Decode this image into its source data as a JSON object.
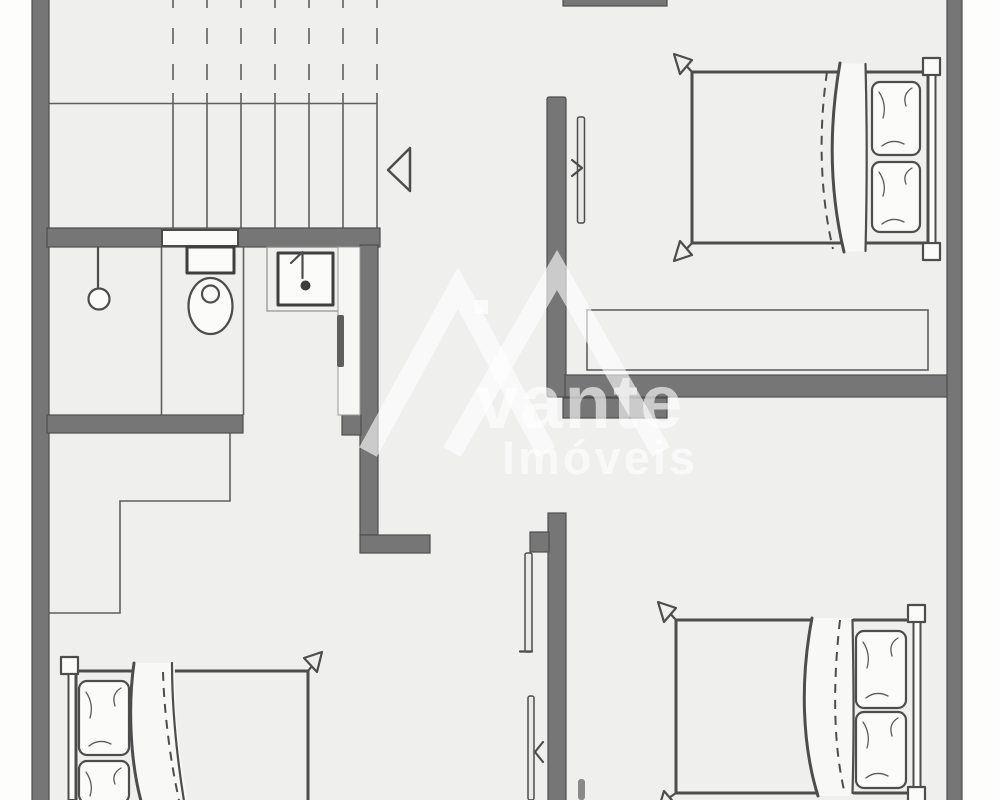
{
  "watermark": {
    "brand_fragment": "vante",
    "subtitle": "Imóveis",
    "logo": "avante-house-roof-logo"
  },
  "colors": {
    "page-bg": "#fdfdfc",
    "floor": "#efefee",
    "wall": "#767676",
    "wall-edge": "#4e4e4e",
    "line": "#5f5f5f",
    "furniture": "#4d4d4d",
    "fixture-fill": "#fbfbfa",
    "watermark": "rgba(255,255,255,0.62)"
  },
  "plan": {
    "type": "architectural-floor-plan",
    "elements": [
      "staircase-with-dashed-cut-line",
      "stair-direction-arrow",
      "shower-head",
      "toilet",
      "washbasin",
      "wall-niche",
      "closet-outline",
      "wardrobe-outline",
      "door-leaf-top-bedroom",
      "door-leaf-hall",
      "door-leaf-bottom-bedroom",
      "double-bed-top-right",
      "double-bed-bottom-right",
      "double-bed-bottom-left"
    ]
  }
}
